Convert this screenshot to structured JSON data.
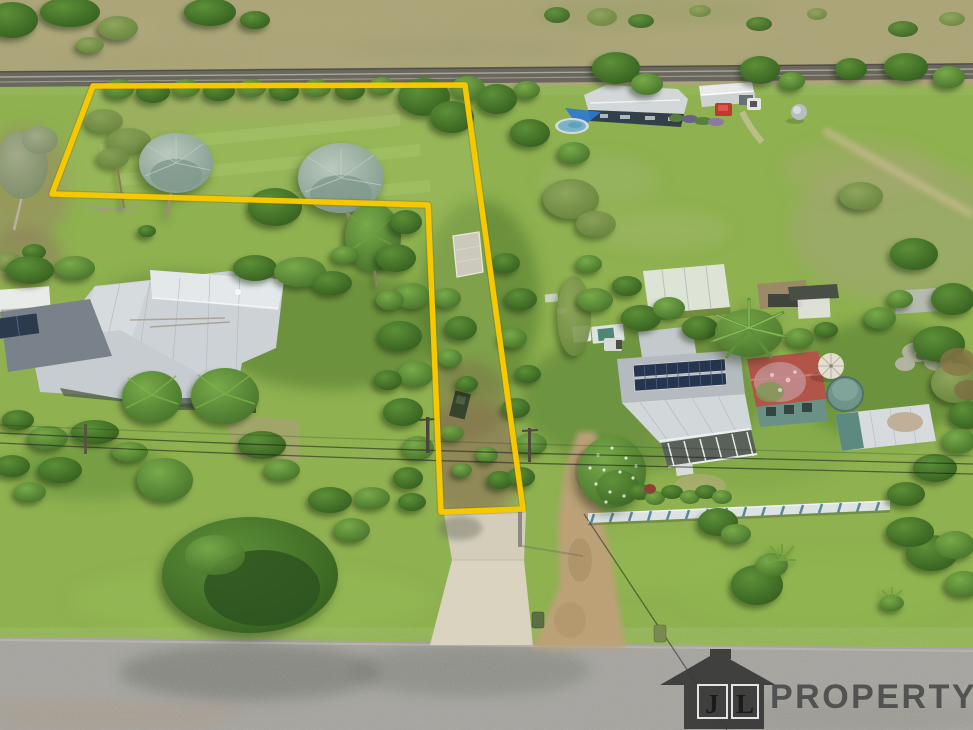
{
  "scene": {
    "type": "aerial-property-photo",
    "description": "Drone aerial photo of a rural residential parcel outlined in yellow: open grass paddock at top, narrow access strip down to a bitumen road, neighbouring houses left and right, railway line across the top",
    "boundary": {
      "color": "#F6C800",
      "points": "93,86 465,85 523,509 441,512 428,205 52,194"
    },
    "palette": {
      "grass": "#8FB150",
      "dry_grass": "#A7A173",
      "road_asphalt": "#A09F9A",
      "railway": "#6A675C",
      "concrete_driveway": "#D9D3C0",
      "dirt_track": "#BCA177",
      "roof_light_gray": "#CCD2D5",
      "roof_red": "#B25548",
      "solar_panel": "#26354E",
      "pool_blue": "#7AB3C6",
      "shade_sail_blue": "#2B79CF",
      "fence_white": "#DDE2E3",
      "fence_teal": "#5E8696"
    }
  },
  "watermark": {
    "icon": "house-logo",
    "icon_color": "#3A3A3A",
    "initial_left": "J",
    "initial_right": "L",
    "name": "PROPERTY",
    "text_color": "#4E4E4E"
  }
}
